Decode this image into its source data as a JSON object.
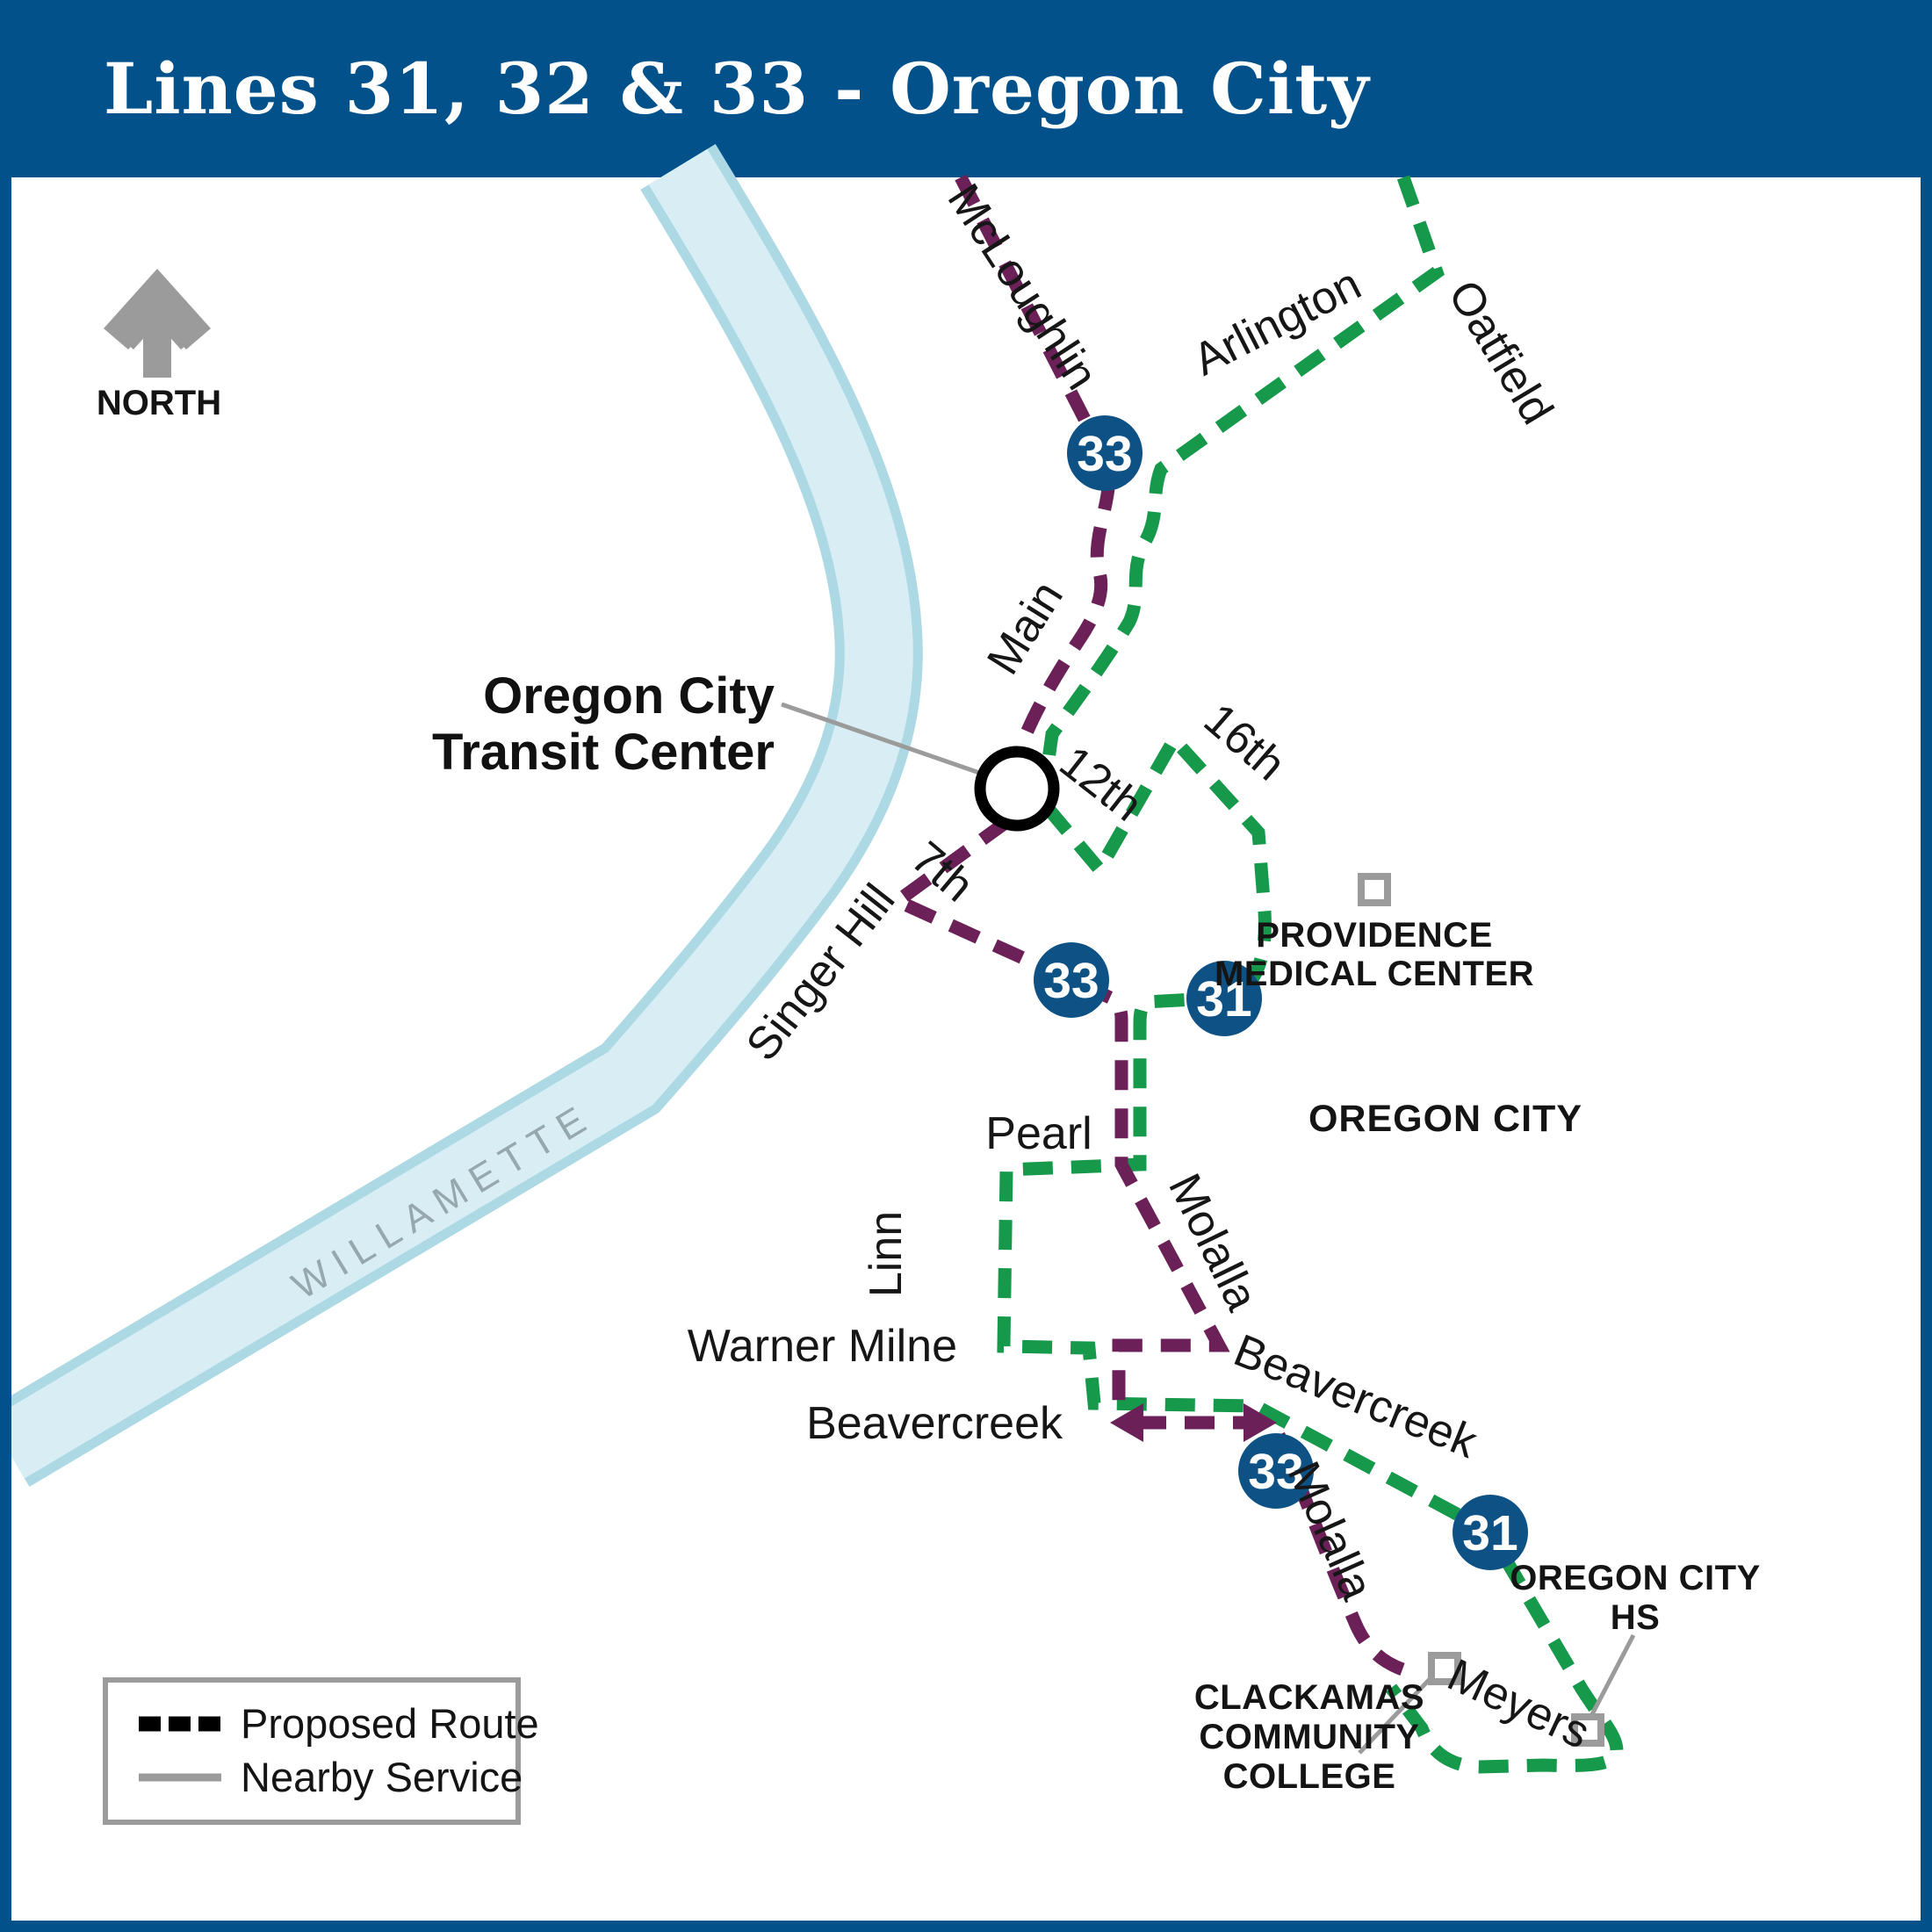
{
  "header": {
    "title": "Lines 31, 32 & 33 - Oregon City"
  },
  "colors": {
    "header_blue": "#02518A",
    "badge_blue": "#0E5285",
    "route_green": "#16994B",
    "route_purple": "#6B2158",
    "river_edge": "#ACD9E4",
    "river_fill": "#D8EEF4",
    "gray": "#9B9B9B",
    "black_dash": "#000000"
  },
  "north": {
    "label": "NORTH"
  },
  "river": {
    "name": "WILLAMETTE"
  },
  "badges": [
    {
      "label": "33"
    },
    {
      "label": "33"
    },
    {
      "label": "31"
    },
    {
      "label": "33"
    },
    {
      "label": "31"
    }
  ],
  "streets": {
    "mcloughlin": "McLoughlin",
    "arlington": "Arlington",
    "oatfield": "Oatfield",
    "main": "Main",
    "twelfth": "12th",
    "sixteenth": "16th",
    "seventh": "7th",
    "singer_hill": "Singer Hill",
    "pearl": "Pearl",
    "linn": "Linn",
    "warner_milne": "Warner Milne",
    "beavercreek_w": "Beavercreek",
    "beavercreek_e": "Beavercreek",
    "molalla_upper": "Molalla",
    "molalla_lower": "Molalla",
    "meyers": "Meyers"
  },
  "landmarks": {
    "transit_center": {
      "line1": "Oregon City",
      "line2": "Transit Center"
    },
    "providence": {
      "line1": "PROVIDENCE",
      "line2": "MEDICAL CENTER"
    },
    "oregon_city": "OREGON CITY",
    "clackamas": {
      "line1": "CLACKAMAS",
      "line2": "COMMUNITY",
      "line3": "COLLEGE"
    },
    "oregon_city_hs": {
      "line1": "OREGON CITY",
      "line2": "HS"
    }
  },
  "legend": {
    "proposed": "Proposed Route",
    "nearby": "Nearby Service"
  }
}
